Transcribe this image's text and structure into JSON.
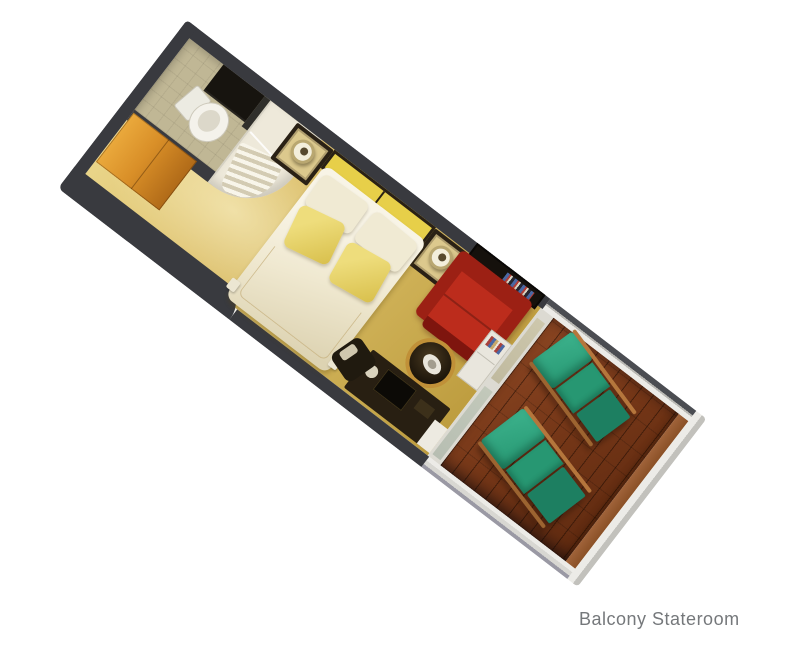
{
  "caption": {
    "text": "Balcony Stateroom"
  },
  "colors": {
    "bg": "#ffffff",
    "wall": "#393a3f",
    "carpet1": "#ecd98f",
    "carpet2": "#d3b65d",
    "carpet3": "#bd9c3e",
    "bath-floor": "#c0b795",
    "fixture-white": "#eee9da",
    "vanity": "#17140f",
    "wardrobe1": "#eaa93c",
    "wardrobe2": "#b06a18",
    "headboard": "#e7cf49",
    "trim-dark": "#2a2115",
    "bed1": "#f8f4e6",
    "bed2": "#ddd3b2",
    "pillow-white": "#f0ead3",
    "pillow-yellow1": "#eedd7c",
    "pillow-yellow2": "#d8bf4b",
    "nightstand-top": "#dcc98d",
    "sofa1": "#bc2c1c",
    "sofa2": "#9c2014",
    "sofa3": "#7e150e",
    "table-gold": "#c09038",
    "deck1": "#8a4522",
    "deck2": "#5f2a10",
    "deck-trim": "#a0633a",
    "rail-light": "#ecebe7",
    "green1": "#3cb28c",
    "green2": "#279772",
    "green3": "#1d7f61",
    "wood-rail": "#b5763c",
    "glass1": "#cdc7ac",
    "glass2": "#b7beb2",
    "cabinet": "#e9e6dd",
    "caption": "#75787b"
  },
  "floorplan": {
    "room_type": "Balcony Stateroom",
    "view": "isometric-top-down-3d-render",
    "areas": [
      "bathroom",
      "entry",
      "bedroom",
      "sitting-area",
      "balcony"
    ],
    "furniture": [
      "vanity",
      "toilet",
      "shower-tub",
      "wardrobe",
      "queen-bed",
      "white-pillows",
      "yellow-accent-pillows",
      "headboard",
      "nightstand-left",
      "nightstand-right",
      "bedside-lamps",
      "red-sofa",
      "wall-art",
      "round-side-table",
      "desk-with-tv",
      "desk-chair",
      "shelf-cabinet",
      "sliding-glass-door",
      "lounge-chair-1",
      "lounge-chair-2"
    ]
  }
}
